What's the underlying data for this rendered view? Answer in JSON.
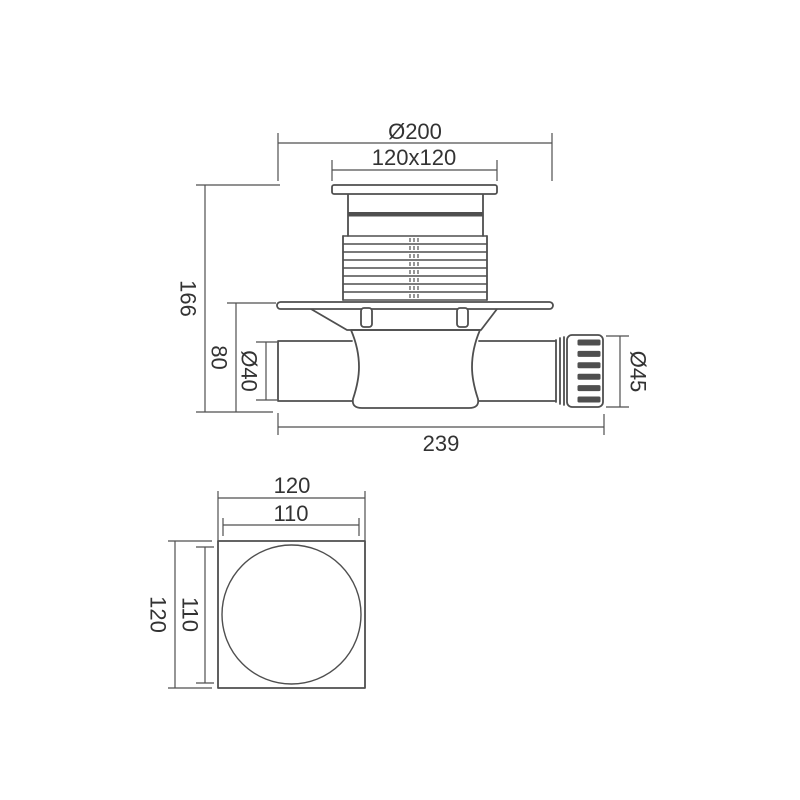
{
  "colors": {
    "line": "#4f4f4f",
    "text": "#333333",
    "background": "#ffffff"
  },
  "side_view": {
    "dims": {
      "flange_diameter": "Ø200",
      "grate_size": "120x120",
      "total_height": "166",
      "body_height": "80",
      "inlet_diameter": "Ø40",
      "outlet_diameter": "Ø45",
      "total_length": "239"
    }
  },
  "top_view": {
    "dims": {
      "outer_width": "120",
      "inner_width": "110",
      "inner_height": "110",
      "outer_height": "120"
    }
  }
}
